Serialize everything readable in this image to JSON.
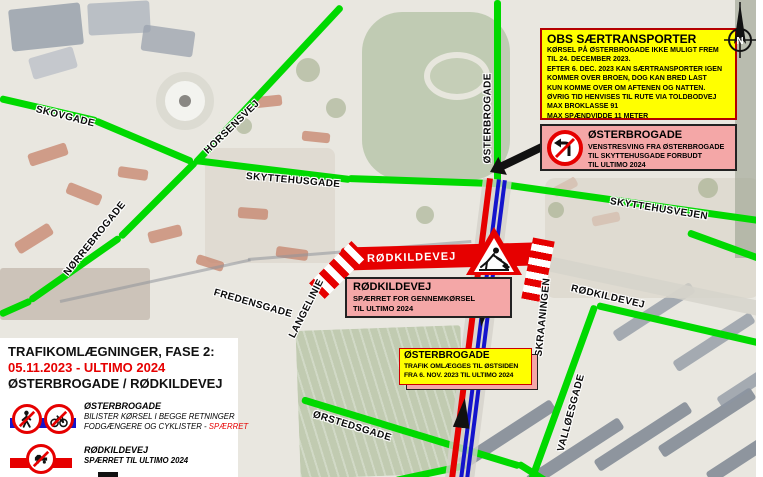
{
  "plan": {
    "title_line1": "TRAFIKOMLÆGNINGER, FASE 2:",
    "title_line2": "05.11.2023 - ULTIMO 2024",
    "title_line3": "ØSTERBROGADE / RØDKILDEVEJ"
  },
  "legend": {
    "item1": {
      "name": "ØSTERBROGADE",
      "line1": "BILISTER KØRSEL I BEGGE RETNINGER",
      "line2a": "FODGÆNGERE OG CYKLISTER - ",
      "line2b": "SPÆRRET"
    },
    "item2": {
      "name": "RØDKILDEVEJ",
      "line1": "SPÆRRET TIL ULTIMO 2024"
    }
  },
  "boxes": {
    "obs": {
      "title": "OBS SÆRTRANSPORTER",
      "lines": [
        "KØRSEL PÅ ØSTERBROGADE IKKE MULIGT FREM",
        "TIL 24. DECEMBER 2023.",
        "EFTER 6. DEC. 2023 KAN SÆRTRANSPORTER IGEN",
        "KOMMER OVER BROEN, DOG KAN BRED LAST",
        "KUN KOMME OVER OM AFTENEN OG NATTEN.",
        "ØVRIG TID HENVISES TIL RUTE VIA TOLDBODVEJ",
        "MAX BROKLASSE 91",
        "MAX SPÆNDVIDDE 11 METER"
      ]
    },
    "no_left_turn": {
      "title": "ØSTERBROGADE",
      "lines": [
        "VENSTRESVING FRA ØSTERBROGADE",
        "TIL SKYTTEHUSGADE FORBUDT",
        "TIL ULTIMO 2024"
      ]
    },
    "rodkildevej_closed": {
      "title": "RØDKILDEVEJ",
      "lines": [
        "SPÆRRET FOR GENNEMKØRSEL",
        "TIL ULTIMO 2024"
      ]
    },
    "traffic_diverted": {
      "title": "ØSTERBROGADE",
      "lines": [
        "TRAFIK OMLÆGGES TIL ØSTSIDEN",
        "FRA 6. NOV. 2023 TIL ULTIMO 2024"
      ]
    }
  },
  "streets": {
    "skovgade": "SKOVGADE",
    "horsensvej": "HORSENSVEJ",
    "norrebrogade": "NØRREBROGADE",
    "skyttehusgade": "SKYTTEHUSGADE",
    "osterbrogade": "ØSTERBROGADE",
    "skyttehusvejen": "SKYTTEHUSVEJEN",
    "fredensgade": "FREDENSGADE",
    "langelinie": "LANGELINIE",
    "rodkildevej_band": "RØDKILDEVEJ",
    "rodkildevej_east": "RØDKILDEVEJ",
    "skraaningen": "SKRAANINGEN",
    "valloesgade": "VALLØESGADE",
    "orstedsgade": "ØRSTEDSGADE"
  },
  "compass": {
    "label": "N"
  },
  "colors": {
    "open_road_green": "#00d900",
    "closed_road_red": "#e60000",
    "diverted_lane_blue": "#1414cc",
    "warning_box_yellow": "#ffff00",
    "notice_box_pink": "#f4a7a7",
    "highlight_red": "#e60000"
  }
}
